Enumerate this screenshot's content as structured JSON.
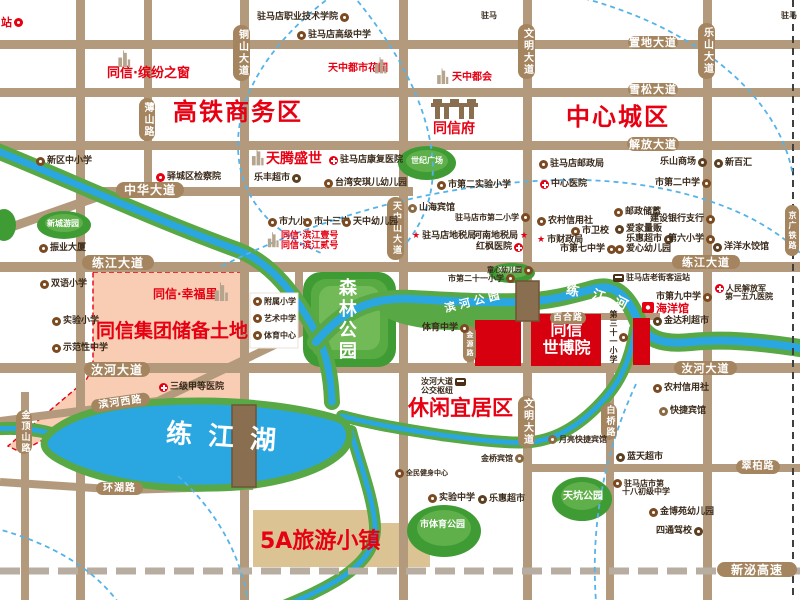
{
  "colors": {
    "accent_red": "#e60012",
    "road": "#b49a7c",
    "road_pill": "#a5855f",
    "water_blue": "#2aa7e1",
    "river_green": "#58a846",
    "park_green": "#3f9c35",
    "park_green_light": "#5fb04a",
    "pink_zone": "#f8cdb4",
    "reserve_tan": "#dcc394",
    "project_red_block": "#d6000f",
    "bridge_brown": "#8a6e50",
    "poi_text": "#3a2a1a",
    "rail_dash": "#3f3f3f",
    "highway_dash": "#b7aea1",
    "arc_blue": "#54b3e8"
  },
  "road_pills": [
    {
      "t": "置地大道",
      "x": 628,
      "y": 36,
      "w": 50,
      "h": 13
    },
    {
      "t": "雪松大道",
      "x": 628,
      "y": 83,
      "w": 50,
      "h": 13
    },
    {
      "t": "解放大道",
      "x": 627,
      "y": 137,
      "w": 52,
      "h": 14
    },
    {
      "t": "中华大道",
      "x": 116,
      "y": 182,
      "w": 68,
      "h": 16,
      "fs": 12
    },
    {
      "t": "练江大道",
      "x": 82,
      "y": 255,
      "w": 72,
      "h": 15,
      "fs": 12
    },
    {
      "t": "练江大道",
      "x": 672,
      "y": 255,
      "w": 68,
      "h": 14
    },
    {
      "t": "汝河大道",
      "x": 84,
      "y": 362,
      "w": 66,
      "h": 15,
      "fs": 12
    },
    {
      "t": "汝河大道",
      "x": 674,
      "y": 361,
      "w": 63,
      "h": 14
    },
    {
      "t": "滨河西路",
      "x": 91,
      "y": 396,
      "w": 59,
      "h": 13,
      "fs": 10,
      "rot": -8
    },
    {
      "t": "环湖路",
      "x": 96,
      "y": 482,
      "w": 47,
      "h": 13,
      "fs": 10
    },
    {
      "t": "翠柏路",
      "x": 736,
      "y": 460,
      "w": 44,
      "h": 14,
      "fs": 10
    },
    {
      "t": "新泌高速",
      "x": 717,
      "y": 562,
      "w": 80,
      "h": 15,
      "fs": 12
    },
    {
      "t": "百合路",
      "x": 550,
      "y": 312,
      "w": 36,
      "h": 12,
      "fs": 9
    },
    {
      "t": "金顶山路",
      "x": 16,
      "y": 410,
      "w": 16,
      "h": 44,
      "v": 1,
      "fs": 9
    },
    {
      "t": "薄山路",
      "x": 139,
      "y": 98,
      "w": 16,
      "h": 43,
      "v": 1,
      "fs": 10
    },
    {
      "t": "铜山大道",
      "x": 233,
      "y": 25,
      "w": 17,
      "h": 56,
      "v": 1,
      "fs": 10
    },
    {
      "t": "天中山大道",
      "x": 387,
      "y": 197,
      "w": 17,
      "h": 63,
      "v": 1,
      "fs": 9
    },
    {
      "t": "文明大道",
      "x": 518,
      "y": 24,
      "w": 17,
      "h": 55,
      "v": 1,
      "fs": 10
    },
    {
      "t": "文明大道",
      "x": 518,
      "y": 396,
      "w": 17,
      "h": 52,
      "v": 1,
      "fs": 10
    },
    {
      "t": "乐山大道",
      "x": 698,
      "y": 23,
      "w": 17,
      "h": 56,
      "v": 1,
      "fs": 10
    },
    {
      "t": "白桥路",
      "x": 601,
      "y": 403,
      "w": 16,
      "h": 37,
      "v": 1,
      "fs": 9
    },
    {
      "t": "京广铁路",
      "x": 785,
      "y": 205,
      "w": 14,
      "h": 51,
      "v": 1,
      "fs": 8
    },
    {
      "t": "金源路",
      "x": 463,
      "y": 326,
      "w": 13,
      "h": 36,
      "v": 1,
      "fs": 7
    }
  ],
  "labels": [
    {
      "t": "高铁商务区",
      "x": 173,
      "y": 100,
      "cls": "district",
      "fs": 24,
      "ls": 2
    },
    {
      "t": "中心城区",
      "x": 566,
      "y": 105,
      "cls": "district",
      "fs": 24,
      "ls": 2
    },
    {
      "t": "休闲宜居区",
      "x": 408,
      "y": 397,
      "cls": "district",
      "fs": 21
    },
    {
      "t": "5A旅游小镇",
      "x": 260,
      "y": 530,
      "cls": "district",
      "fs": 22
    },
    {
      "t": "同信集团储备土地",
      "x": 96,
      "y": 322,
      "cls": "district",
      "fs": 19
    },
    {
      "t": "同信·缤纷之窗",
      "x": 107,
      "y": 67,
      "cls": "proj",
      "fs": 13
    },
    {
      "t": "天中都市花园",
      "x": 328,
      "y": 64,
      "cls": "proj",
      "fs": 10
    },
    {
      "t": "天中都会",
      "x": 452,
      "y": 73,
      "cls": "proj",
      "fs": 10
    },
    {
      "t": "同信府",
      "x": 433,
      "y": 122,
      "cls": "proj",
      "fs": 14
    },
    {
      "t": "天腾盛世",
      "x": 266,
      "y": 152,
      "cls": "proj",
      "fs": 14
    },
    {
      "t": "同信·幸福里",
      "x": 153,
      "y": 288,
      "cls": "proj",
      "fs": 12
    },
    {
      "t": "同信·滨江壹号",
      "x": 281,
      "y": 232,
      "cls": "proj",
      "fs": 9
    },
    {
      "t": "同信·滨江贰号",
      "x": 281,
      "y": 242,
      "cls": "proj",
      "fs": 9
    },
    {
      "t": "海洋馆",
      "x": 656,
      "y": 303,
      "cls": "proj",
      "fs": 11
    },
    {
      "t": "森林公园",
      "x": 336,
      "y": 278,
      "cls": "park v",
      "fs": 18
    },
    {
      "t": "世纪广场",
      "x": 411,
      "y": 157,
      "cls": "park",
      "fs": 8
    },
    {
      "t": "新城游园",
      "x": 47,
      "y": 220,
      "cls": "park",
      "fs": 8
    },
    {
      "t": "天坑公园",
      "x": 563,
      "y": 492,
      "cls": "park",
      "fs": 10
    },
    {
      "t": "市体育公园",
      "x": 420,
      "y": 521,
      "cls": "park",
      "fs": 9
    },
    {
      "t": "滨河游园",
      "x": 498,
      "y": 268,
      "cls": "park",
      "fs": 6
    },
    {
      "t": "滨河公园",
      "x": 444,
      "y": 296,
      "cls": "park",
      "fs": 11,
      "rot": -14,
      "ls": 4
    },
    {
      "t": "练江湖",
      "x": 166,
      "y": 425,
      "cls": "water",
      "fs": 26,
      "ls": 16,
      "rot": 4
    },
    {
      "t": "练",
      "x": 566,
      "y": 285,
      "cls": "water",
      "fs": 13,
      "rot": 12
    },
    {
      "t": "江",
      "x": 592,
      "y": 290,
      "cls": "water",
      "fs": 13,
      "rot": 18
    },
    {
      "t": "河",
      "x": 614,
      "y": 297,
      "cls": "water",
      "fs": 13,
      "rot": 28
    },
    {
      "t": "同信",
      "x": 533,
      "y": 322,
      "cls": "expo",
      "fs": 16,
      "w": 67
    },
    {
      "t": "世博院",
      "x": 533,
      "y": 340,
      "cls": "expo",
      "fs": 16,
      "w": 67
    }
  ],
  "pois": [
    {
      "t": "站",
      "x": 1,
      "y": 17,
      "icon": "train",
      "side": "r",
      "red": 1,
      "fs": 11
    },
    {
      "t": "驻马店职业技术学院",
      "x": 257,
      "y": 13,
      "icon": "school",
      "side": "r"
    },
    {
      "t": "驻马",
      "x": 481,
      "y": 12,
      "fs": 8
    },
    {
      "t": "驻马",
      "x": 781,
      "y": 12,
      "fs": 8
    },
    {
      "t": "驻马店高级中学",
      "x": 297,
      "y": 31,
      "icon": "school",
      "side": "l"
    },
    {
      "t": "新区中小学",
      "x": 36,
      "y": 157,
      "icon": "school",
      "side": "l"
    },
    {
      "t": "驿城区检察院",
      "x": 156,
      "y": 173,
      "icon": "gov",
      "side": "l"
    },
    {
      "t": "乐丰超市",
      "x": 254,
      "y": 174,
      "icon": "shop",
      "side": "r"
    },
    {
      "t": "驻马店康复医院",
      "x": 329,
      "y": 156,
      "icon": "hospital",
      "side": "l"
    },
    {
      "t": "台湾安琪儿幼儿园",
      "x": 324,
      "y": 179,
      "icon": "school",
      "side": "l"
    },
    {
      "t": "市第二实验小学",
      "x": 437,
      "y": 181,
      "icon": "school",
      "side": "l"
    },
    {
      "t": "驻马店邮政局",
      "x": 539,
      "y": 160,
      "icon": "post",
      "side": "l"
    },
    {
      "t": "中心医院",
      "x": 540,
      "y": 180,
      "icon": "hospital",
      "side": "l"
    },
    {
      "t": "乐山商场",
      "x": 660,
      "y": 158,
      "icon": "shop",
      "side": "r"
    },
    {
      "t": "市第二中学",
      "x": 655,
      "y": 179,
      "icon": "school",
      "side": "r"
    },
    {
      "t": "新百汇",
      "x": 714,
      "y": 159,
      "icon": "shop",
      "side": "l"
    },
    {
      "t": "山海宾馆",
      "x": 408,
      "y": 204,
      "icon": "hotel",
      "side": "l"
    },
    {
      "t": "驻马店市第二小学",
      "x": 455,
      "y": 213,
      "icon": "school",
      "side": "r",
      "fs": 8
    },
    {
      "t": "市九小",
      "x": 268,
      "y": 218,
      "icon": "school",
      "side": "l"
    },
    {
      "t": "市十三中",
      "x": 303,
      "y": 218,
      "icon": "school",
      "side": "l"
    },
    {
      "t": "天中幼儿园",
      "x": 342,
      "y": 218,
      "icon": "school",
      "side": "l"
    },
    {
      "t": "驻马店地税局",
      "x": 412,
      "y": 232,
      "icon": "star",
      "side": "l"
    },
    {
      "t": "河南地税局",
      "x": 473,
      "y": 232,
      "icon": "star",
      "side": "r"
    },
    {
      "t": "红枫医院",
      "x": 476,
      "y": 243,
      "icon": "hospital",
      "side": "r"
    },
    {
      "t": "农村信用社",
      "x": 537,
      "y": 217,
      "icon": "bank",
      "side": "l"
    },
    {
      "t": "市卫校",
      "x": 571,
      "y": 227,
      "icon": "school",
      "side": "l"
    },
    {
      "t": "市财政局",
      "x": 537,
      "y": 236,
      "icon": "star",
      "side": "l"
    },
    {
      "t": "市第七中学",
      "x": 560,
      "y": 245,
      "icon": "school",
      "side": "r"
    },
    {
      "t": "邮政储蓄",
      "x": 614,
      "y": 208,
      "icon": "post",
      "side": "l"
    },
    {
      "t": "建设银行支行",
      "x": 650,
      "y": 215,
      "icon": "bank",
      "side": "r"
    },
    {
      "t": "爱家量贩",
      "x": 615,
      "y": 225,
      "icon": "shop",
      "side": "l"
    },
    {
      "t": "乐惠超市",
      "x": 626,
      "y": 235,
      "icon": "shop",
      "side": "r"
    },
    {
      "t": "第六小学",
      "x": 668,
      "y": 235,
      "icon": "school",
      "side": "r"
    },
    {
      "t": "爱心幼儿园",
      "x": 615,
      "y": 245,
      "icon": "school",
      "side": "l"
    },
    {
      "t": "洋洋水饺馆",
      "x": 713,
      "y": 243,
      "icon": "shop",
      "side": "l"
    },
    {
      "t": "童心幼儿园",
      "x": 487,
      "y": 266,
      "icon": "school",
      "side": "r",
      "fs": 7
    },
    {
      "t": "市第二十一小学",
      "x": 448,
      "y": 274,
      "icon": "school",
      "side": "r",
      "fs": 8
    },
    {
      "t": "驻马店老街客运站",
      "x": 613,
      "y": 274,
      "icon": "bus",
      "side": "l",
      "fs": 8
    },
    {
      "t": "市第九中学",
      "x": 656,
      "y": 293,
      "icon": "school",
      "side": "r"
    },
    {
      "t": "人民解放军",
      "x": 715,
      "y": 284,
      "icon": "hospital",
      "side": "l",
      "fs": 8
    },
    {
      "t": "第一五九医院",
      "x": 725,
      "y": 293,
      "fs": 8
    },
    {
      "t": "金达利超市",
      "x": 653,
      "y": 317,
      "icon": "shop",
      "side": "l"
    },
    {
      "t": "第三十一小学",
      "x": 609,
      "y": 310,
      "icon": "school",
      "side": "t",
      "v": 1,
      "fs": 8
    },
    {
      "t": "体育中学",
      "x": 422,
      "y": 324,
      "icon": "school",
      "side": "r"
    },
    {
      "t": "双语小学",
      "x": 40,
      "y": 280,
      "icon": "school",
      "side": "l"
    },
    {
      "t": "实验小学",
      "x": 52,
      "y": 317,
      "icon": "school",
      "side": "l"
    },
    {
      "t": "示范性中学",
      "x": 52,
      "y": 344,
      "icon": "school",
      "side": "l"
    },
    {
      "t": "三级甲等医院",
      "x": 159,
      "y": 383,
      "icon": "hospital",
      "side": "l"
    },
    {
      "t": "振业大厦",
      "x": 39,
      "y": 244,
      "icon": "dot",
      "side": "l"
    },
    {
      "t": "附属小学",
      "x": 253,
      "y": 297,
      "icon": "school",
      "side": "l",
      "fs": 8
    },
    {
      "t": "艺术中学",
      "x": 253,
      "y": 314,
      "icon": "school",
      "side": "l",
      "fs": 8
    },
    {
      "t": "体育中心",
      "x": 253,
      "y": 331,
      "icon": "school",
      "side": "l",
      "fs": 8
    },
    {
      "t": "汝河大道",
      "x": 421,
      "y": 378,
      "icon": "bus",
      "side": "r",
      "fs": 8
    },
    {
      "t": "公交枢纽",
      "x": 421,
      "y": 387,
      "fs": 8
    },
    {
      "t": "金桥宾馆",
      "x": 481,
      "y": 454,
      "icon": "hotel",
      "side": "r",
      "fs": 8
    },
    {
      "t": "全民健身中心",
      "x": 395,
      "y": 469,
      "icon": "dot",
      "side": "l",
      "fs": 7
    },
    {
      "t": "实验中学",
      "x": 428,
      "y": 494,
      "icon": "school",
      "side": "l"
    },
    {
      "t": "乐惠超市",
      "x": 478,
      "y": 495,
      "icon": "shop",
      "side": "l"
    },
    {
      "t": "月亮快捷宾馆",
      "x": 548,
      "y": 435,
      "icon": "hotel",
      "side": "l",
      "fs": 8
    },
    {
      "t": "快捷宾馆",
      "x": 659,
      "y": 407,
      "icon": "hotel",
      "side": "l"
    },
    {
      "t": "农村信用社",
      "x": 653,
      "y": 384,
      "icon": "bank",
      "side": "l"
    },
    {
      "t": "蓝天超市",
      "x": 616,
      "y": 453,
      "icon": "shop",
      "side": "l"
    },
    {
      "t": "驻马店市第",
      "x": 613,
      "y": 479,
      "icon": "school",
      "side": "l",
      "fs": 8
    },
    {
      "t": "十八初级中学",
      "x": 622,
      "y": 488,
      "fs": 8
    },
    {
      "t": "金博苑幼儿园",
      "x": 649,
      "y": 508,
      "icon": "school",
      "side": "l"
    },
    {
      "t": "四通驾校",
      "x": 656,
      "y": 527,
      "icon": "car",
      "side": "r"
    }
  ],
  "marker_icons": [
    {
      "type": "building",
      "x": 112,
      "y": 50,
      "w": 24,
      "h": 17
    },
    {
      "type": "building",
      "x": 374,
      "y": 56,
      "w": 13,
      "h": 18
    },
    {
      "type": "building",
      "x": 436,
      "y": 68,
      "w": 13,
      "h": 16
    },
    {
      "type": "building",
      "x": 251,
      "y": 148,
      "w": 13,
      "h": 18
    },
    {
      "type": "building",
      "x": 213,
      "y": 282,
      "w": 16,
      "h": 19
    },
    {
      "type": "building",
      "x": 267,
      "y": 230,
      "w": 12,
      "h": 19
    },
    {
      "type": "gate",
      "x": 431,
      "y": 97,
      "w": 47,
      "h": 23
    },
    {
      "type": "aquarium",
      "x": 642,
      "y": 302,
      "w": 12,
      "h": 11
    }
  ]
}
